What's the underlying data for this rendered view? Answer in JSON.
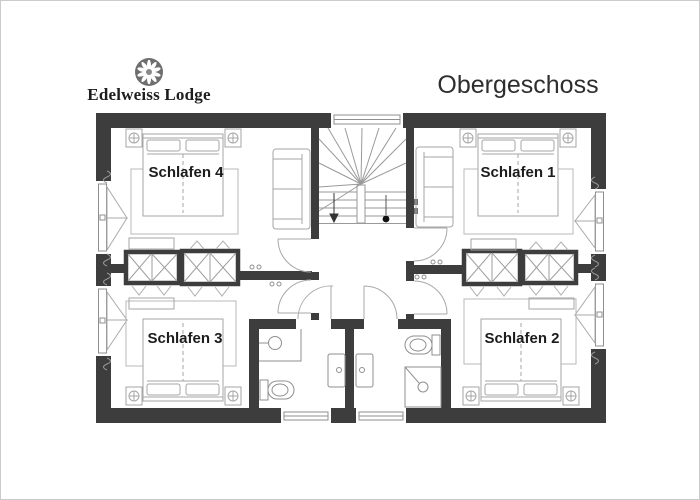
{
  "header": {
    "brand": "Edelweiss Lodge",
    "title": "Obergeschoss"
  },
  "rooms": [
    {
      "id": "schlafen-4",
      "label": "Schlafen 4"
    },
    {
      "id": "schlafen-1",
      "label": "Schlafen 1"
    },
    {
      "id": "schlafen-3",
      "label": "Schlafen 3"
    },
    {
      "id": "schlafen-2",
      "label": "Schlafen 2"
    }
  ],
  "features": {
    "stairs": "winder-staircase",
    "stair_direction_marker": "down-arrow",
    "bathrooms": 2,
    "fixtures": [
      "sink",
      "toilet",
      "shower",
      "vanity-basin"
    ],
    "furniture": [
      "double-bed",
      "nightstand-lamp",
      "rug",
      "bench",
      "sofa",
      "built-in-wardrobe"
    ],
    "windows": 7
  },
  "colors": {
    "wall": "#3d3d3d",
    "furniture_line": "#a6a6a6",
    "fixture_line": "#8f8f8f",
    "rug_line": "#b8b8b8",
    "door_arc": "#a9a9a9",
    "label_text": "#1c1c1c",
    "title_text": "#2e2e2e",
    "logo_circle": "#6e6e6e",
    "page_border": "#cbcbcb"
  }
}
